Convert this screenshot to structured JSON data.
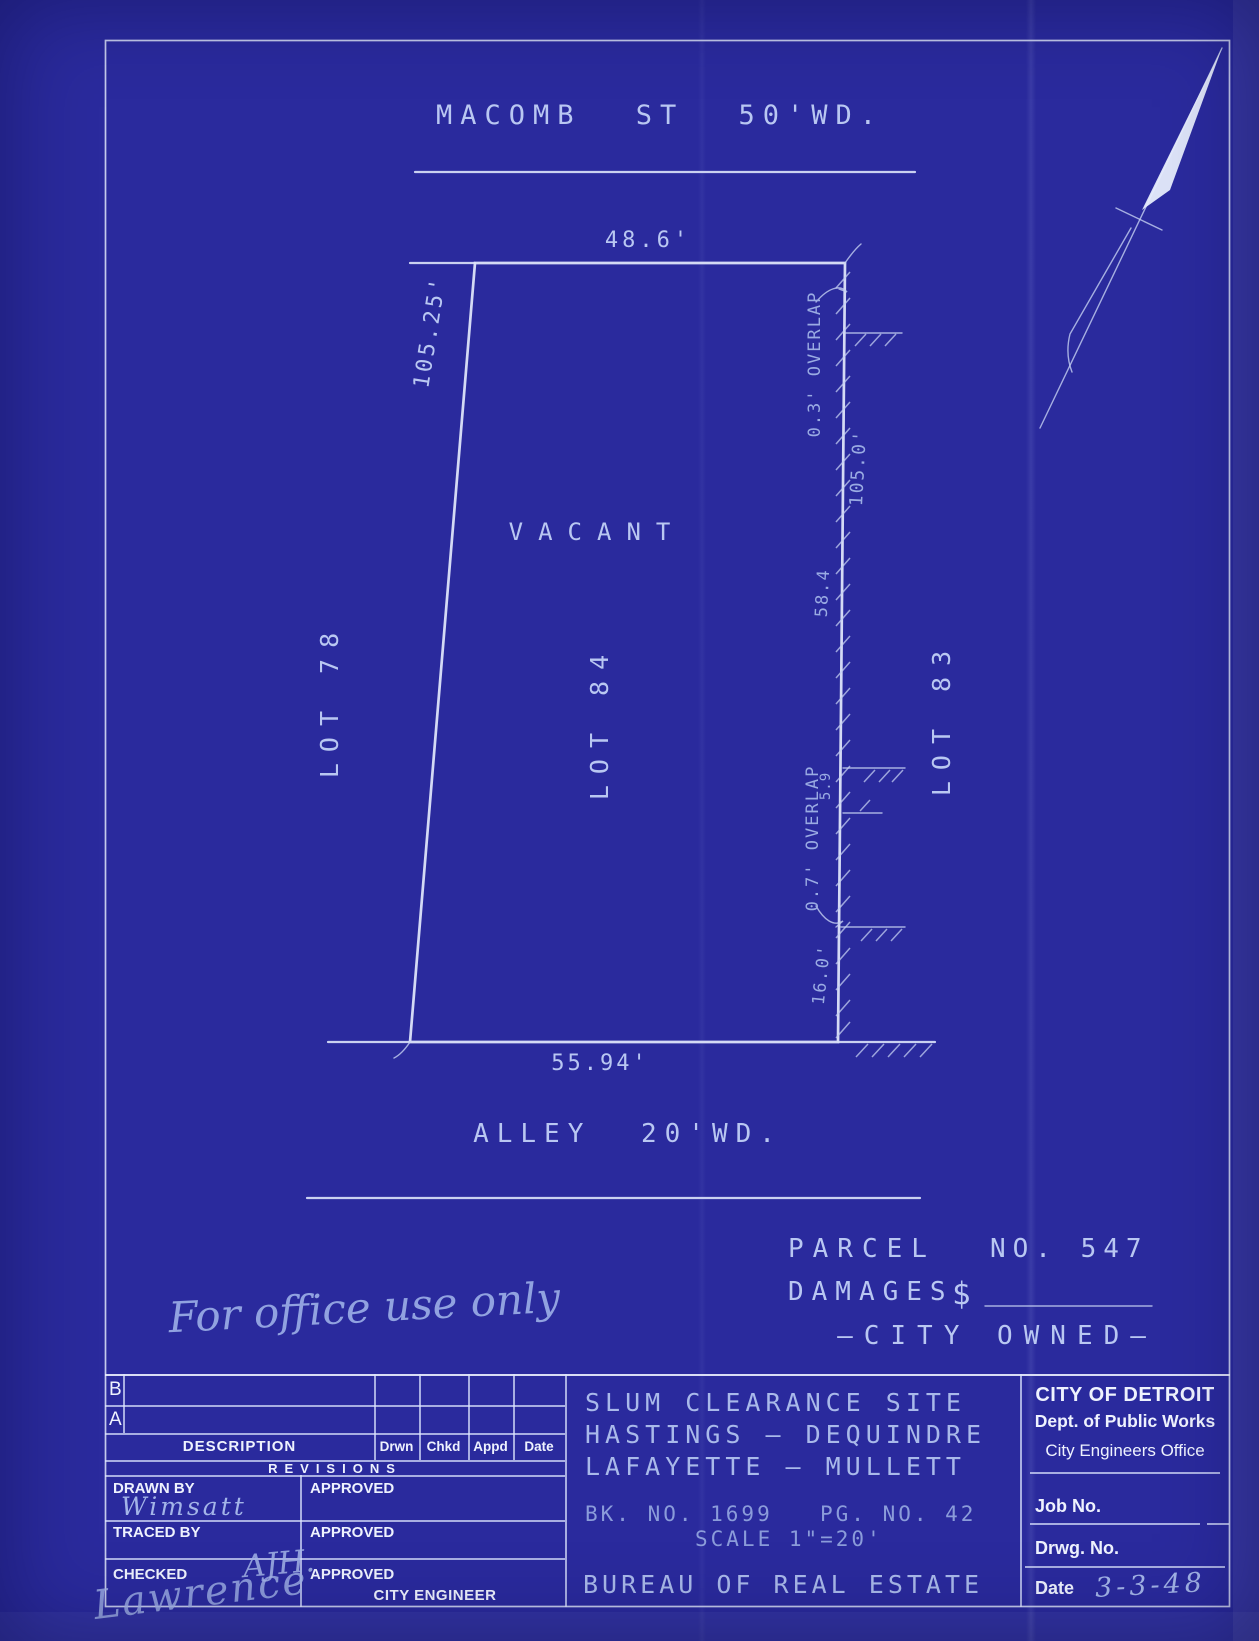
{
  "colors": {
    "paper": "#2a2a9d",
    "ink_line": "#d8e0f8",
    "ink_hand": "#b9c7f2",
    "ink_faint": "#8b9cda",
    "ink_print": "#eef2fe"
  },
  "plan": {
    "street_label": "MACOMB ST 50'WD.",
    "frontage_dim": "48.6'",
    "west_dim": "105.25'",
    "vacant_label": "VACANT",
    "lot_west": "LOT 78",
    "lot_center": "LOT 84",
    "lot_east": "LOT 83",
    "overlap_north": "0.3' OVERLAP",
    "east_dim": "105.0'",
    "dim_58_4": "58.4",
    "overlap_south": "0.7' OVERLAP",
    "dim_5_9": "5.9",
    "dim_16_0": "16.0'",
    "rear_dim": "55.94'",
    "alley_label": "ALLEY 20'WD."
  },
  "notes": {
    "office_note": "For office use only",
    "parcel_label": "PARCEL",
    "parcel_number": "NO. 547",
    "damages_label": "DAMAGES",
    "damages_symbol": "$",
    "ownership": "—CITY OWNED—"
  },
  "titleblock": {
    "revisions": {
      "row_b": "B",
      "row_a": "A",
      "description": "DESCRIPTION",
      "drwn": "Drwn",
      "chkd": "Chkd",
      "appd": "Appd",
      "date": "Date",
      "title": "REVISIONS"
    },
    "drawn_by_label": "DRAWN BY",
    "drawn_by_value": "Wimsatt",
    "traced_by_label": "TRACED BY",
    "checked_label": "CHECKED",
    "checked_initials": "AJH.",
    "checked_signature": "Lawrence",
    "approved_label": "APPROVED",
    "city_engineer_label": "CITY ENGINEER",
    "project": {
      "line1": "SLUM CLEARANCE SITE",
      "line2": "HASTINGS — DEQUINDRE",
      "line3": "LAFAYETTE — MULLETT",
      "book_no": "BK. NO. 1699",
      "page_no": "PG. NO. 42",
      "scale": "SCALE 1\"=20'",
      "bureau": "BUREAU OF REAL ESTATE"
    },
    "agency": {
      "name": "CITY OF DETROIT",
      "dept": "Dept. of Public Works",
      "office": "City Engineers Office",
      "job_no_label": "Job No.",
      "drwg_no_label": "Drwg. No.",
      "date_label": "Date",
      "date_value": "3-3-48"
    }
  }
}
